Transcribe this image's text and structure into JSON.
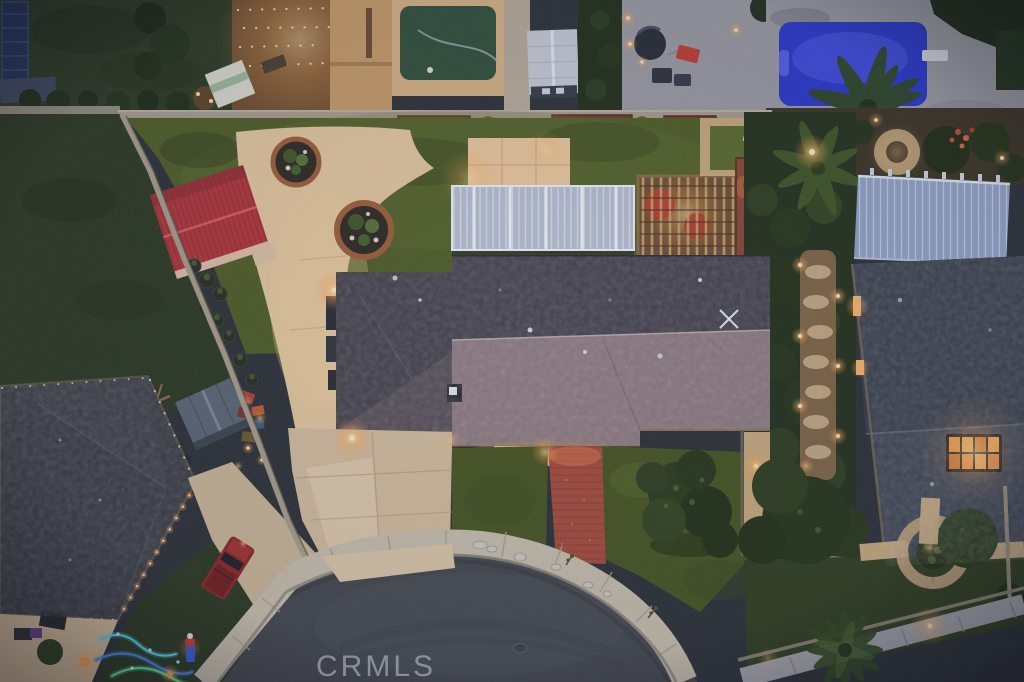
{
  "meta": {
    "type": "aerial-photograph",
    "scene": "Twilight aerial drone view of a suburban home on a cul-de-sac, surrounded by neighboring houses, pool and holiday lights",
    "width": 1024,
    "height": 682
  },
  "watermark": {
    "text": "CRMLS",
    "color": "#c6c9d3"
  },
  "palette": {
    "canvas_base": "#2b2f36",
    "asphalt": "#43464d",
    "sidewalk": "#c9bfae",
    "curb": "#8f897c",
    "driveway": "#d3bd9e",
    "driveway_apron": "#ddc8a8",
    "concrete_warm": "#e4c79e",
    "concrete_pad": "#ecc79c",
    "paver_red": "#a64a3a",
    "step_pads": "#dcbc92",
    "turf": "#4d5c24",
    "front_turf": "#46541f",
    "lawn_neighbor": "#2a3720",
    "lawn_right": "#2f3d1e",
    "roof_main_dark": "#3e3b47",
    "roof_main_lit": "#8d767c",
    "roof_left_wing": "#3d3a45",
    "roof_left_house": "#34353d",
    "roof_right_house": "#3a4150",
    "patio_cover_white": "#b6bfd0",
    "patio_cover_right": "#93a3c6",
    "lattice_wood": "#6e4e33",
    "shed_red": "#b23438",
    "shed_blue": "#5a6575",
    "pool_blue": "#2836cc",
    "pool_deck": "#9b9aa2",
    "garden_soil": "#3a3223",
    "foliage_dark": "#22301a",
    "wall_gray": "#a89d8c",
    "planter_terracotta": "#9e5c39",
    "flower_box": "#70392c",
    "skylight_orange": "#ff9e3e",
    "glow_warm": "#ffb964",
    "truck_red": "#8c2424",
    "navy_bed": "#223055",
    "putting_green": "#2f4e38",
    "white_shed": "#c7ccd6",
    "xmas_cyan": "#52d8f0",
    "xmas_blue": "#4a86f0",
    "xmas_green": "#58e49a",
    "medallion_ring": "#b59a74"
  },
  "objects": [
    "swimming pool",
    "diving board",
    "white aluminum patio cover",
    "wood lattice pergola",
    "red metal shed",
    "round terracotta planters",
    "artificial turf backyard",
    "concrete driveway",
    "red brick paver walkway",
    "cul-de-sac street",
    "curved sidewalk",
    "red pickup truck",
    "christmas light strings",
    "holiday inflatable",
    "solar attic fan",
    "lit skylights",
    "circular paver medallion",
    "palm trees",
    "raised garden beds",
    "hot tub cover",
    "backyard putting green",
    "white storage shed",
    "string lights",
    "landscape lighting",
    "CRMLS watermark"
  ]
}
